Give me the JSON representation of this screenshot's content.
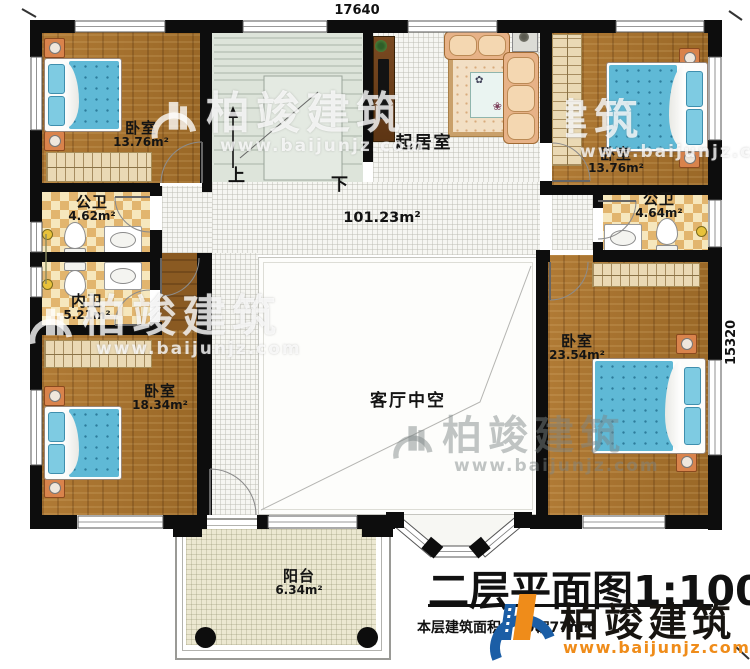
{
  "plan": {
    "dimensions": {
      "top": "17640",
      "right": "15320"
    },
    "stairs": {
      "up": "上",
      "down": "下"
    },
    "rooms": {
      "bedroom_tl": {
        "name": "卧室",
        "area": "13.76m²"
      },
      "bedroom_tr": {
        "name": "卧室",
        "area": "13.76m²"
      },
      "living": {
        "name": "起居室",
        "area": "101.23m²"
      },
      "bath_left": {
        "name": "公卫",
        "area": "4.62m²"
      },
      "bath_inner": {
        "name": "内卫",
        "area": "5.21m²"
      },
      "bath_right": {
        "name": "公卫",
        "area": "4.64m²"
      },
      "bedroom_bl": {
        "name": "卧室",
        "area": "18.34m²"
      },
      "bedroom_br": {
        "name": "卧室",
        "area": "23.54m²"
      },
      "void": {
        "name": "客厅中空"
      },
      "balcony": {
        "name": "阳台",
        "area": "6.34m²"
      }
    },
    "title_block": {
      "title": "二层平面图1:100",
      "area_label": "本层建筑面积：",
      "area_value": "208.77m²",
      "hidden_fragment_1": "层",
      "hidden_fragment_2": "6"
    },
    "watermark": {
      "brand": "柏竣建筑",
      "url": "www.baijunjz.com"
    },
    "logo": {
      "brand": "柏竣建筑",
      "url": "www.baijunjz.com"
    },
    "colors": {
      "wall": "#0d0d0d",
      "wood": "#a9742f",
      "tile": "#f6f6f2",
      "bath": "#e2b56e",
      "stairs": "#dde4da",
      "balcony": "#ece8d1",
      "bed": "#5fb9d6",
      "logo_blue": "#1b5ea6",
      "logo_orange": "#ef8c1a"
    }
  }
}
